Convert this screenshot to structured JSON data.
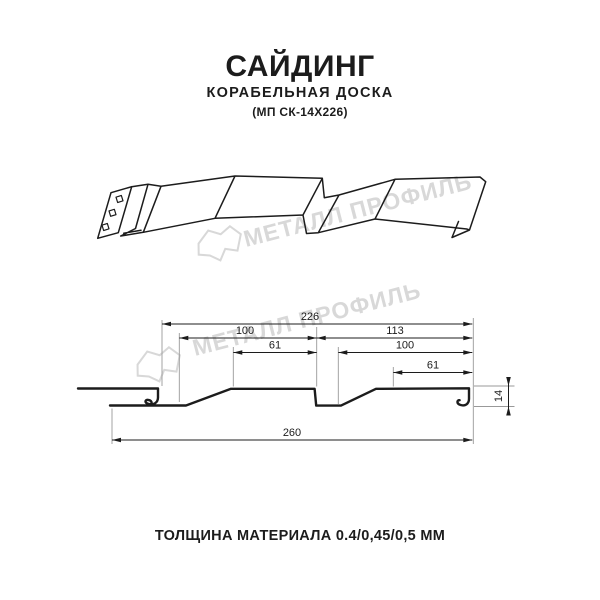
{
  "header": {
    "title": "САЙДИНГ",
    "subtitle": "КОРАБЕЛЬНАЯ ДОСКА",
    "model": "(МП СК-14Х226)"
  },
  "footer": {
    "note": "ТОЛЩИНА МАТЕРИАЛА 0.4/0,45/0,5 ММ"
  },
  "watermark": {
    "text": "МЕТАЛЛ ПРОФИЛЬ",
    "logo_icon": "metall-profil-logo",
    "color": "#d8d8d8"
  },
  "dims": {
    "d226": "226",
    "d100_left": "100",
    "d113": "113",
    "d61_left": "61",
    "d100_right": "100",
    "d61_right": "61",
    "d14": "14",
    "d260": "260"
  },
  "colors": {
    "ink": "#1c1c1c",
    "extension_line": "#999999",
    "watermark": "#d8d8d8"
  }
}
